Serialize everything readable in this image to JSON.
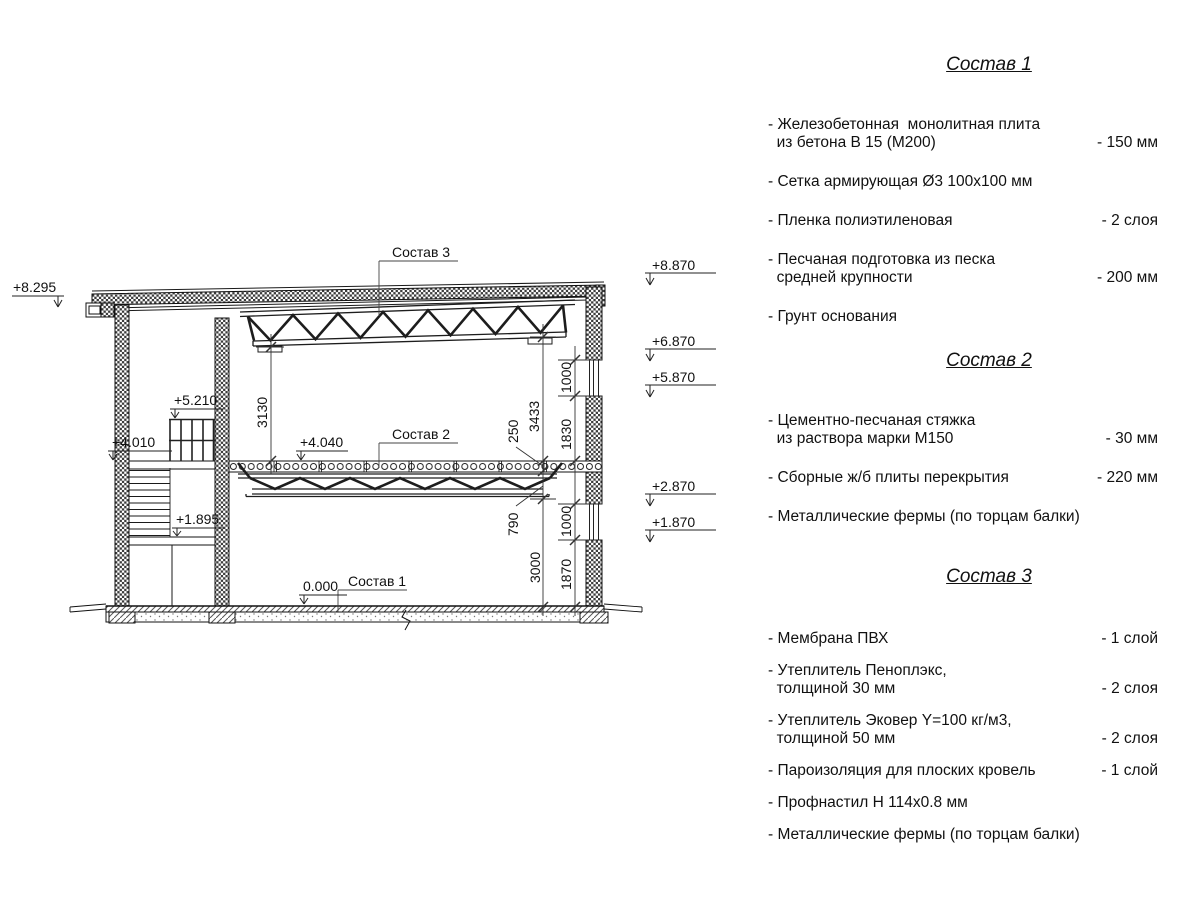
{
  "drawing": {
    "callouts": {
      "c1": "Состав 1",
      "c2": "Состав 2",
      "c3": "Состав 3"
    },
    "marks": {
      "m8295": "+8.295",
      "m8870": "+8.870",
      "m6870": "+6.870",
      "m5870": "+5.870",
      "m2870": "+2.870",
      "m1870": "+1.870",
      "m5210": "+5.210",
      "m4010": "+4.010",
      "m4040": "+4.040",
      "m1895": "+1.895",
      "m0000": "0.000"
    },
    "dims": {
      "d3130": "3130",
      "d3433": "3433",
      "d250": "250",
      "d1000a": "1000",
      "d1830": "1830",
      "d790": "790",
      "d3000": "3000",
      "d1000b": "1000",
      "d1870": "1870"
    }
  },
  "panel": {
    "comp1": {
      "title": "Состав 1",
      "items": [
        {
          "name": "- Железобетонная  монолитная плита\n  из бетона В 15 (М200)",
          "value": "- 150 мм"
        },
        {
          "name": "- Сетка армирующая Ø3 100х100 мм",
          "value": ""
        },
        {
          "name": "- Пленка полиэтиленовая",
          "value": "-  2 слоя"
        },
        {
          "name": "- Песчаная подготовка из песка\n  средней крупности",
          "value": "- 200 мм"
        },
        {
          "name": "- Грунт основания",
          "value": ""
        }
      ]
    },
    "comp2": {
      "title": "Состав 2",
      "items": [
        {
          "name": "- Цементно-песчаная стяжка\n  из раствора марки М150",
          "value": "- 30 мм"
        },
        {
          "name": "- Сборные ж/б плиты перекрытия",
          "value": "- 220 мм"
        },
        {
          "name": "- Металлические фермы (по торцам балки)",
          "value": ""
        }
      ]
    },
    "comp3": {
      "title": "Состав 3",
      "items": [
        {
          "name": "- Мембрана ПВХ",
          "value": "- 1 слой"
        },
        {
          "name": "- Утеплитель Пеноплэкс,\n  толщиной 30 мм",
          "value": "- 2 слоя"
        },
        {
          "name": "- Утеплитель Эковер Y=100 кг/м3,\n  толщиной 50 мм",
          "value": "- 2 слоя"
        },
        {
          "name": "- Пароизоляция для плоских кровель",
          "value": "- 1 слой"
        },
        {
          "name": "- Профнастил Н 114х0.8 мм",
          "value": ""
        },
        {
          "name": "- Металлические фермы (по торцам балки)",
          "value": ""
        }
      ]
    }
  }
}
